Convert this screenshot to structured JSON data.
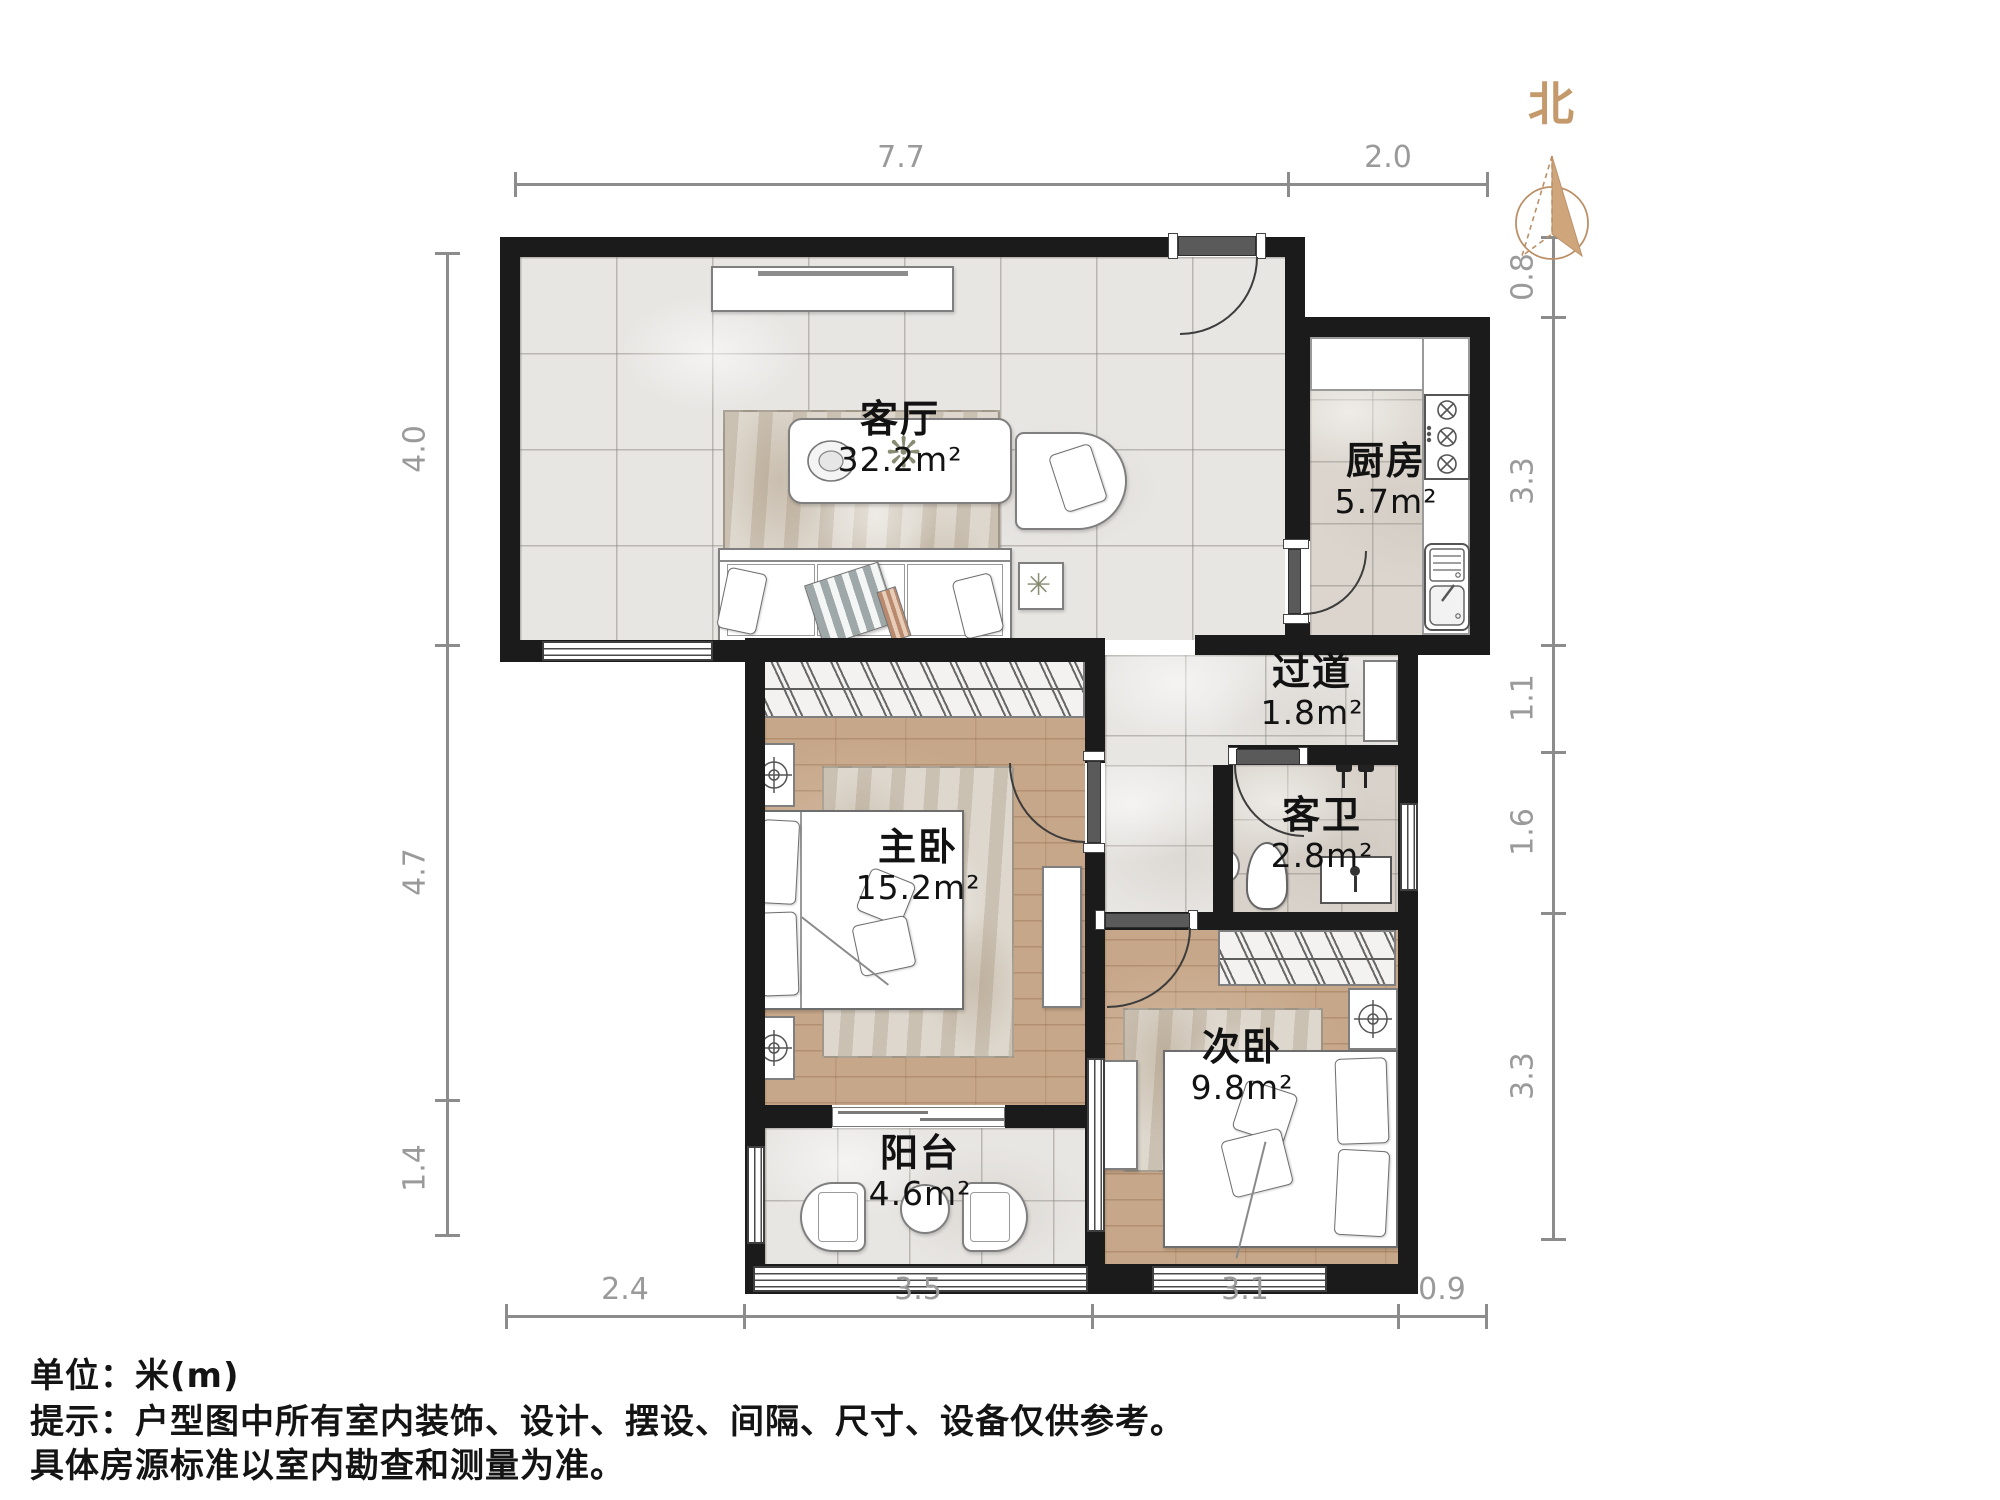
{
  "compass": {
    "north_label": "北"
  },
  "rooms": {
    "living": {
      "name": "客厅",
      "area": "32.2m²"
    },
    "kitchen": {
      "name": "厨房",
      "area": "5.7m²"
    },
    "hallway": {
      "name": "过道",
      "area": "1.8m²"
    },
    "bathroom": {
      "name": "客卫",
      "area": "2.8m²"
    },
    "master_bedroom": {
      "name": "主卧",
      "area": "15.2m²"
    },
    "second_bedroom": {
      "name": "次卧",
      "area": "9.8m²"
    },
    "balcony": {
      "name": "阳台",
      "area": "4.6m²"
    }
  },
  "dimensions": {
    "top": [
      "7.7",
      "2.0"
    ],
    "bottom": [
      "2.4",
      "3.5",
      "3.1",
      "0.9"
    ],
    "left": [
      "4.0",
      "4.7",
      "1.4"
    ],
    "right": [
      "0.8",
      "3.3",
      "1.1",
      "1.6",
      "3.3"
    ]
  },
  "footer": {
    "units": "单位：米(m)",
    "tip_line1": "提示：户型图中所有室内装饰、设计、摆设、间隔、尺寸、设备仅供参考。",
    "tip_line2": "具体房源标准以室内勘查和测量为准。"
  },
  "colors": {
    "wall": "#1b1b1b",
    "compass": "#c49a6c",
    "dimension": "#8c8c8c",
    "wood": "#c7a789"
  }
}
